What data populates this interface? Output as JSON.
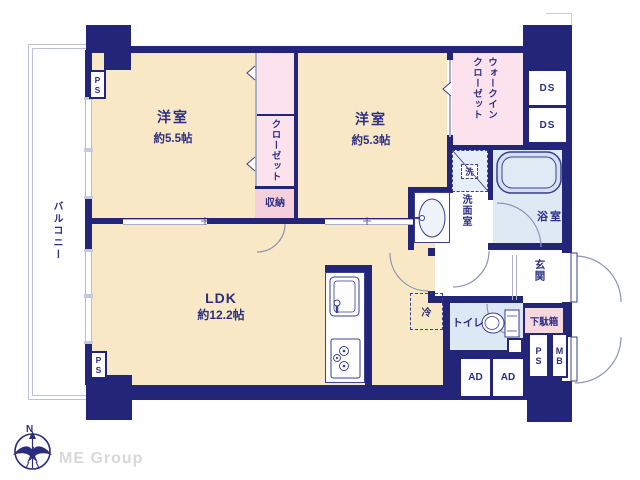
{
  "plan": {
    "bedroom1": {
      "name": "洋室",
      "size": "約5.5帖"
    },
    "bedroom2": {
      "name": "洋室",
      "size": "約5.3帖"
    },
    "ldk": {
      "name": "LDK",
      "size": "約12.2帖"
    },
    "balcony": "バルコニー",
    "closet": "クローゼット",
    "storage": "収納",
    "walk_in_closet": "ウォークイン\nクローゼット",
    "laundry": "洗",
    "washroom": "洗面室",
    "bathroom": "浴室",
    "toilet": "トイレ",
    "refrigerator": "冷",
    "entrance": "玄関",
    "shoe_cabinet": "下駄箱"
  },
  "shafts": {
    "ds_top": "DS",
    "ds_bottom": "DS",
    "ps_top_left": "PS",
    "ps_bottom_left": "PS",
    "ps_entrance": "PS",
    "mb": "MB",
    "ad_left": "AD",
    "ad_right": "AD"
  },
  "branding": {
    "compass_north": "N",
    "logo": "ME Group"
  },
  "colors": {
    "wall": "#232578",
    "room_cream": "#f8e8c6",
    "closet_pink": "#fce2ec",
    "storage_pink": "#f6cfdd",
    "wet_blue": "#dfe9f4",
    "toilet_blue": "#dce8f3",
    "logo_gray": "#d8d8da"
  }
}
